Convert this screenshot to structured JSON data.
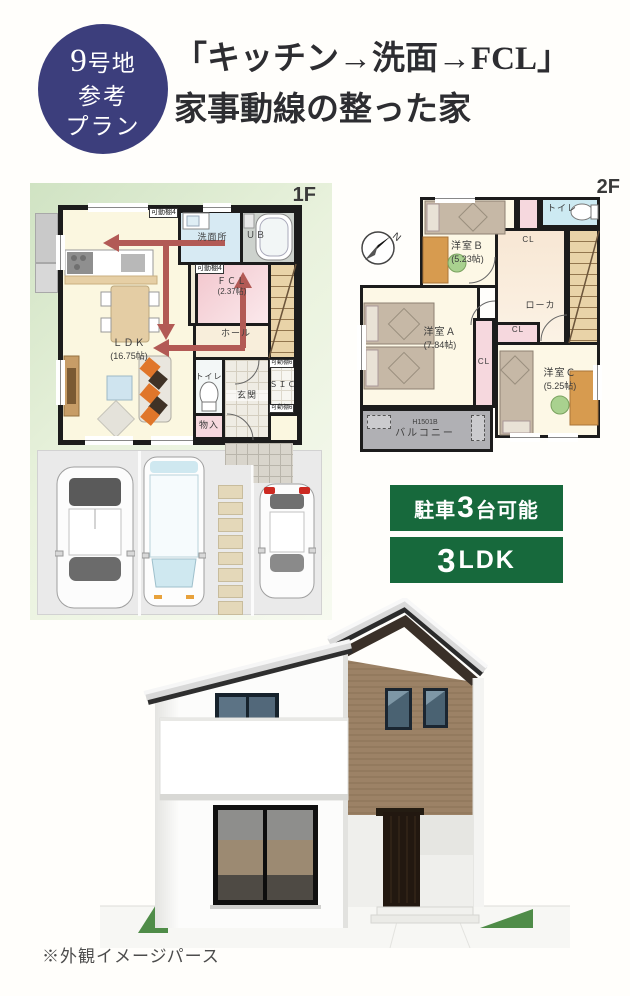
{
  "header": {
    "badge_num": "9",
    "badge_line1": "号地",
    "badge_line2": "参考",
    "badge_line3": "プラン",
    "title1": "「キッチン→洗面→FCL」",
    "title2": "家事動線の整った家"
  },
  "floor1": {
    "label": "1F",
    "ldk": "ＬＤＫ",
    "ldk_size": "(16.75帖)",
    "senmen": "洗面所",
    "ub": "ＵＢ",
    "shelf_top": "可動棚4",
    "shelf_mid": "可動棚4",
    "fcl": "ＦＣＬ",
    "fcl_size": "(2.37帖)",
    "hall": "ホール",
    "toilet": "トイレ",
    "genkan": "玄関",
    "sic": "ＳＩＣ",
    "sic_shelf_top": "可動棚6",
    "sic_shelf_btm": "可動棚6",
    "monoire": "物入"
  },
  "floor2": {
    "label": "2F",
    "compass": "N",
    "room_b": "洋室Ｂ",
    "room_b_size": "(5.23帖)",
    "room_a": "洋室Ａ",
    "room_a_size": "(7.84帖)",
    "room_c": "洋室Ｃ",
    "room_c_size": "(5.25帖)",
    "toilet": "トイレ",
    "cl_b": "CL",
    "cl_mid": "CL",
    "cl_c": "CL",
    "hallway": "ローカ",
    "balcony_code": "H1501B",
    "balcony": "バルコニー"
  },
  "badges": {
    "parking_prefix": "駐車",
    "parking_count": "3",
    "parking_suffix": "台可能",
    "plan_count": "3",
    "plan_type": "LDK"
  },
  "caption": "※外観イメージパース",
  "colors": {
    "navy": "#3c3e7c",
    "badge_green": "#17693c",
    "arrow_red": "#b25a55",
    "plan_pink": "#f6d8de",
    "plan_blue": "#d7eaf3",
    "plan_cream": "#fbf7e0",
    "plan_tan": "#e9d3a8",
    "wall": "#1c1c1c"
  }
}
